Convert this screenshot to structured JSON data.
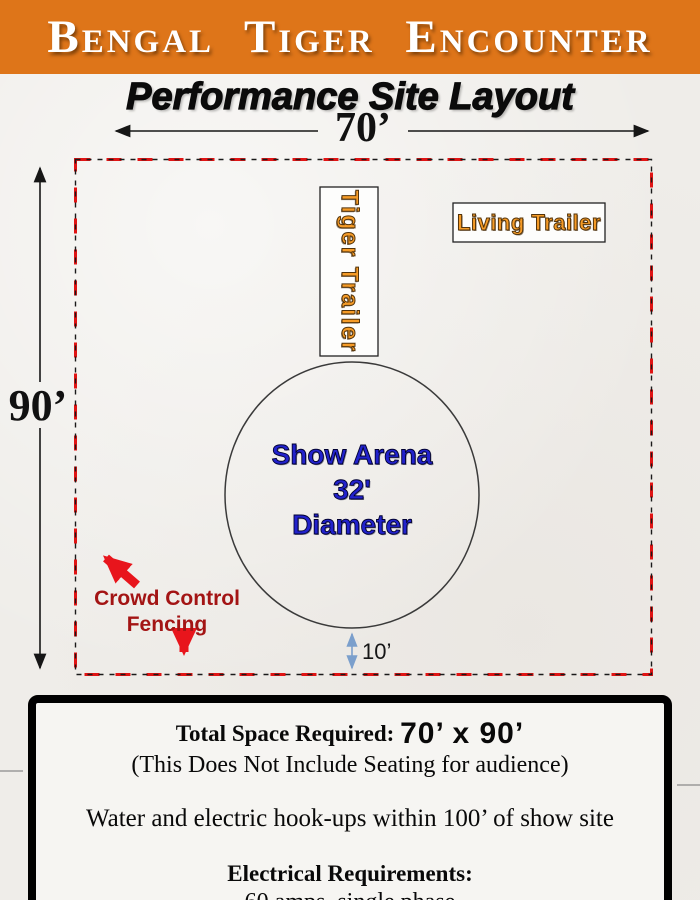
{
  "header": {
    "title": "Bengal Tiger Encounter"
  },
  "subtitle": "Performance Site Layout",
  "diagram": {
    "width_label": "70’",
    "height_label": "90’",
    "gap_label": "10’",
    "tiger_trailer_label": "Tiger Trailer",
    "living_trailer_label": "Living Trailer",
    "arena": {
      "line1": "Show Arena",
      "line2": "32'",
      "line3": "Diameter"
    },
    "crowd_control": {
      "line1": "Crowd Control",
      "line2": "Fencing"
    }
  },
  "info_box": {
    "total_label": "Total Space Required:",
    "total_value": "70’ x 90’",
    "seating_note": "(This Does Not Include Seating for audience)",
    "hookups_note": "Water and electric hook-ups within 100’ of show site",
    "electrical_label": "Electrical Requirements:",
    "electrical_value": "60 amps, single phase"
  },
  "colors": {
    "header_orange": "#de7519",
    "trailer_text_orange": "#f59b27",
    "arena_blue": "#2222cc",
    "crowd_text_red": "#a31414",
    "arrow_red": "#e8151c",
    "boundary_dash_red": "#e01414",
    "boundary_dash_black": "#1a1a1a",
    "gap_arrow_blue": "#7b9fcc",
    "page_background": "#efede9"
  }
}
